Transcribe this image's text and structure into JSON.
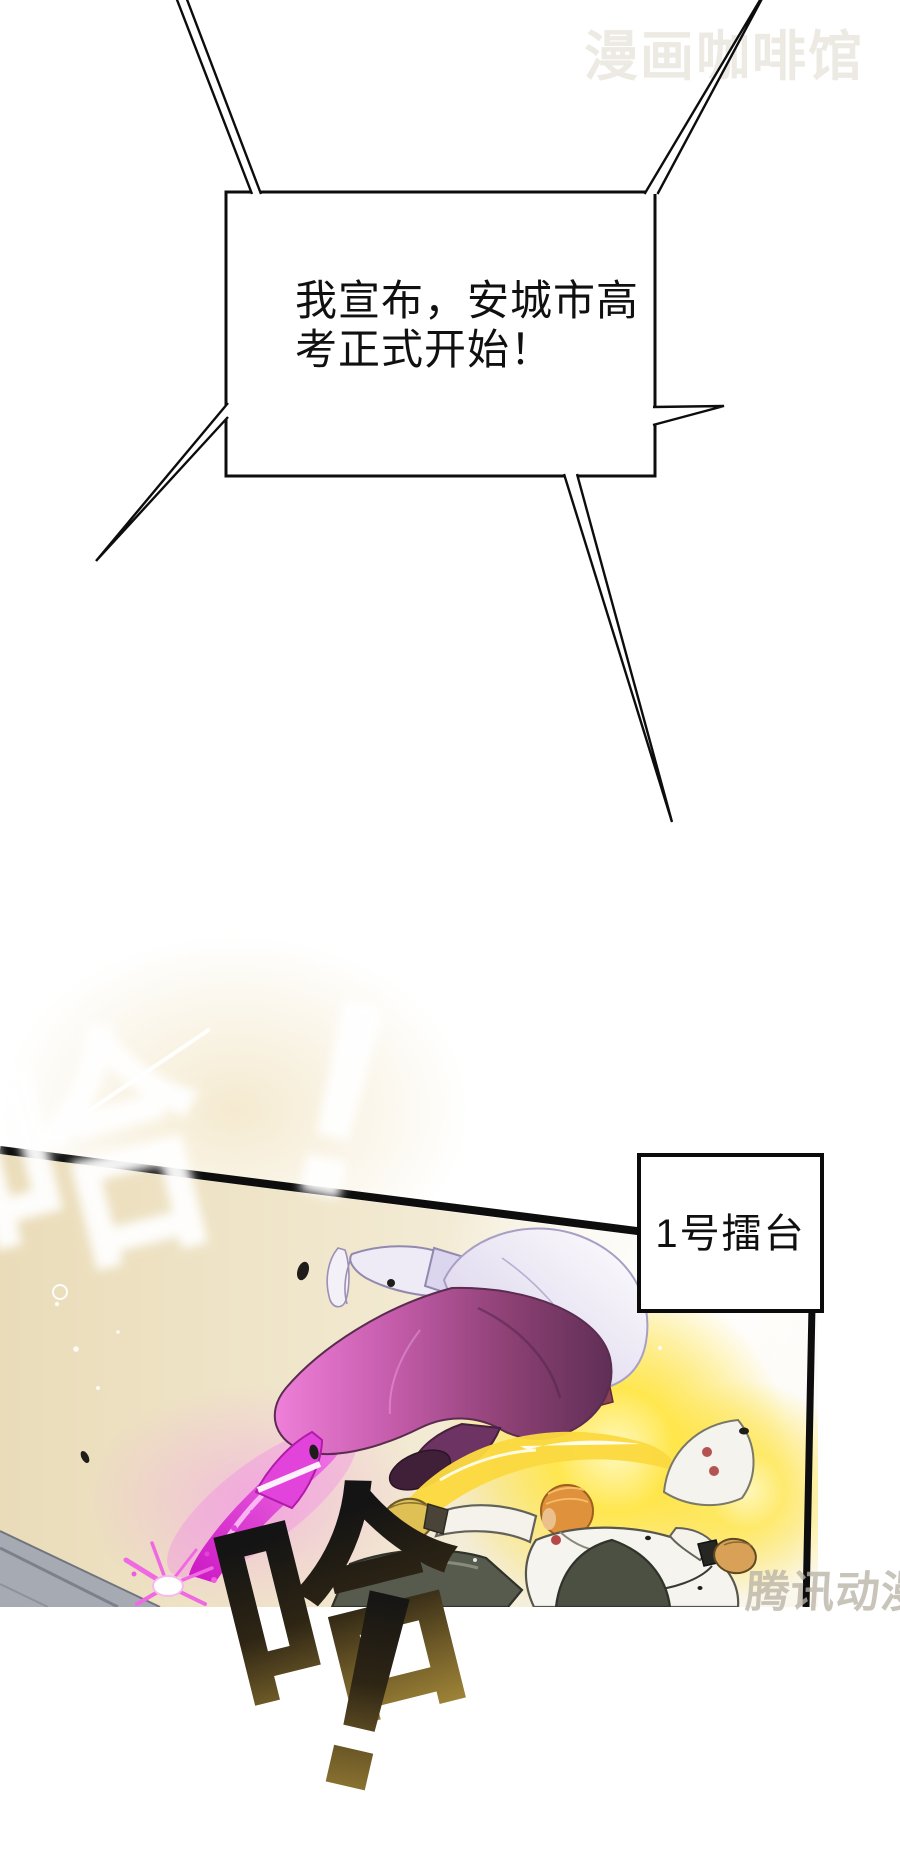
{
  "page": {
    "type": "comic-page",
    "background": "#ffffff"
  },
  "watermarks": {
    "top_right": "漫画咖啡馆",
    "bottom_right": "腾讯动漫"
  },
  "speech_bubble": {
    "lines": [
      "我宣布，安城市高",
      "考正式开始！"
    ]
  },
  "sfx": {
    "ha": "哈",
    "bang": "!"
  },
  "label_box": {
    "text": "1号擂台"
  },
  "palette": {
    "ink": "#0d0d0d",
    "watermark_top_color": "#edeae3",
    "watermark_bottom_color": "#bab3a6",
    "panel_cream": "#ecdfc0",
    "energy_magenta": "#e243da",
    "energy_yellow": "#ffe14a",
    "calligraphy_gold": "#9b8136",
    "pants_purple": "#8c4073",
    "floor_gray": "#a6abb3"
  }
}
